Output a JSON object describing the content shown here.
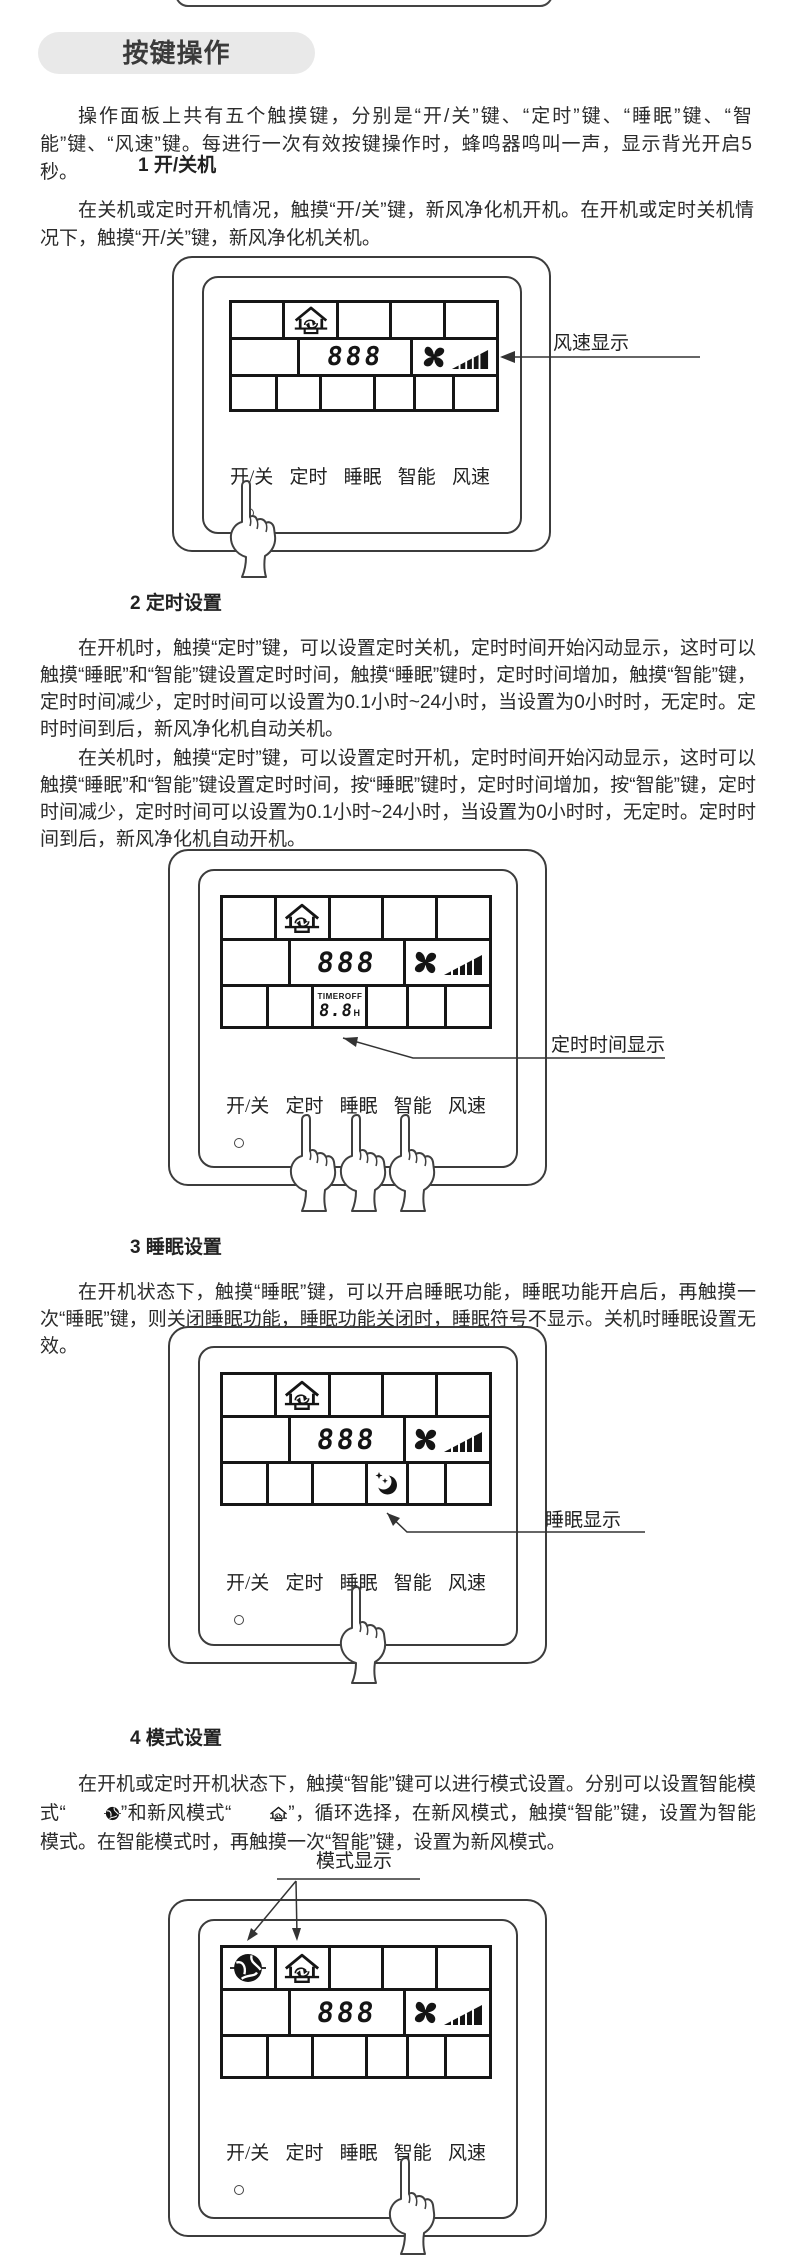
{
  "page": {
    "section_pill": "按键操作"
  },
  "intro": "操作面板上共有五个触摸键，分别是“开/关”键、“定时”键、“睡眠”键、“智能”键、“风速”键。每进行一次有效按键操作时，蜂鸣器鸣叫一声，显示背光开启5秒。",
  "sections": [
    {
      "heading": "1 开/关机",
      "paragraphs": [
        "在关机或定时开机情况，触摸“开/关”键，新风净化机开机。在开机或定时关机情况下，触摸“开/关”键，新风净化机关机。"
      ]
    },
    {
      "heading": "2 定时设置",
      "paragraphs": [
        "在开机时，触摸“定时”键，可以设置定时关机，定时时间开始闪动显示，这时可以触摸“睡眠”和“智能”键设置定时时间，触摸“睡眠”键时，定时时间增加，触摸“智能”键，定时时间减少，定时时间可以设置为0.1小时~24小时，当设置为0小时时，无定时。定时时间到后，新风净化机自动关机。",
        "在关机时，触摸“定时”键，可以设置定时开机，定时时间开始闪动显示，这时可以触摸“睡眠”和“智能”键设置定时时间，按“睡眠”键时，定时时间增加，按“智能”键，定时时间减少，定时时间可以设置为0.1小时~24小时，当设置为0小时时，无定时。定时时间到后，新风净化机自动开机。"
      ]
    },
    {
      "heading": "3 睡眠设置",
      "paragraphs": [
        "在开机状态下，触摸“睡眠”键，可以开启睡眠功能，睡眠功能开启后，再触摸一次“睡眠”键，则关闭睡眠功能，睡眠功能关闭时，睡眠符号不显示。关机时睡眠设置无效。"
      ]
    },
    {
      "heading": "4 模式设置",
      "parts": {
        "before_icon1": "在开机或定时开机状态下，触摸“智能”键可以进行模式设置。分别可以设置智能模式“",
        "between_icons": "”和新风模式“",
        "after_icon2": "”，循环选择，在新风模式，触摸“智能”键，设置为智能模式。在智能模式时，再触摸一次“智能”键，设置为新风模式。"
      }
    }
  ],
  "panel": {
    "buttons": [
      "开/关",
      "定时",
      "睡眠",
      "智能",
      "风速"
    ],
    "lcd": {
      "digits": "888",
      "timer_label": "TIMER",
      "timer_state": "OFF",
      "timer_value": "8.8",
      "timer_unit": "H"
    }
  },
  "callouts": {
    "fan_speed": "风速显示",
    "timer_time": "定时时间显示",
    "sleep": "睡眠显示",
    "mode": "模式显示"
  },
  "colors": {
    "page_bg": "#ffffff",
    "ink": "#2b2b2b",
    "panel_line": "#3c3c3c",
    "lcd_ink": "#151515",
    "pill_bg": "#e9e9e9"
  }
}
